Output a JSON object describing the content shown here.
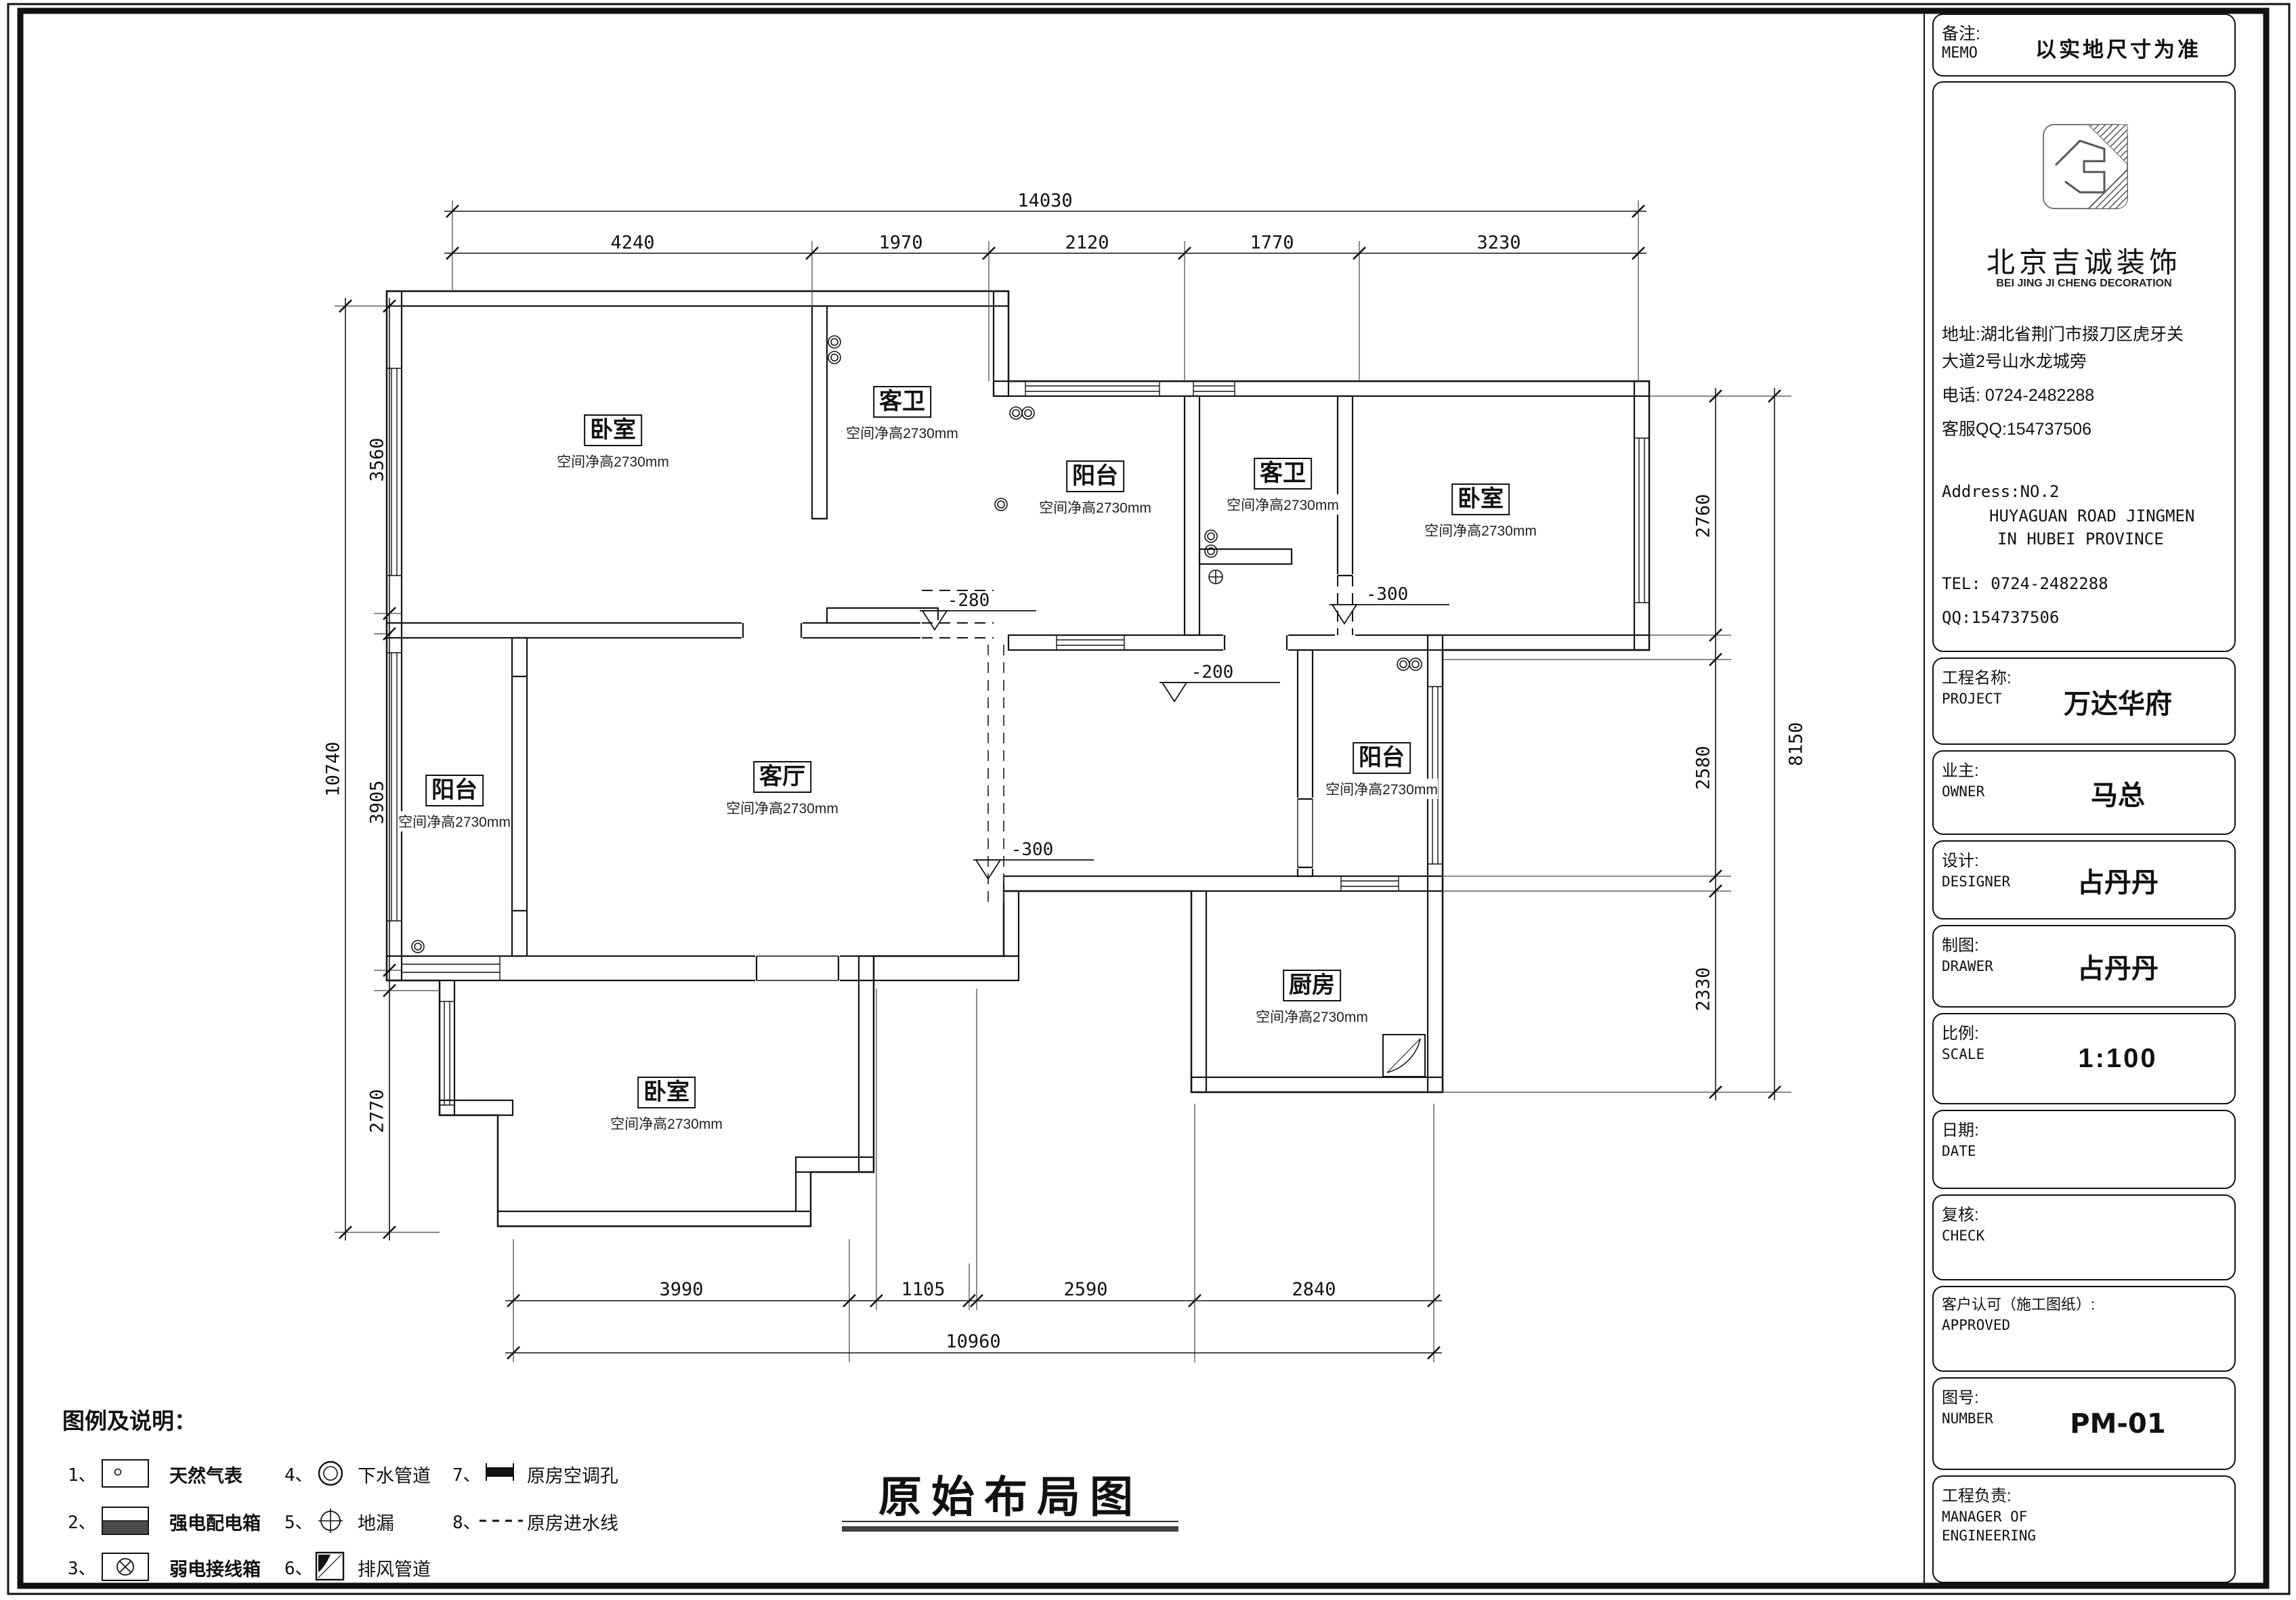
{
  "drawing_title": "原始布局图",
  "memo": {
    "label_cn": "备注:",
    "label_en": "MEMO",
    "value": "以实地尺寸为准"
  },
  "company": {
    "name_cn": "北京吉诚装饰",
    "name_en": "BEI JING JI CHENG DECORATION",
    "addr1": "地址:湖北省荆门市掇刀区虎牙关",
    "addr2": "大道2号山水龙城旁",
    "phone": "电话: 0724-2482288",
    "qq": "客服QQ:154737506",
    "addr_en1": "Address:NO.2",
    "addr_en2": "HUYAGUAN ROAD JINGMEN",
    "addr_en3": "IN HUBEI PROVINCE",
    "tel_en": "TEL: 0724-2482288",
    "qq_en": "QQ:154737506"
  },
  "titleblock": {
    "rows": [
      {
        "label_cn": "工程名称:",
        "label_en": "PROJECT",
        "value": "万达华府"
      },
      {
        "label_cn": "业主:",
        "label_en": "OWNER",
        "value": "马总"
      },
      {
        "label_cn": "设计:",
        "label_en": "DESIGNER",
        "value": "占丹丹"
      },
      {
        "label_cn": "制图:",
        "label_en": "DRAWER",
        "value": "占丹丹"
      },
      {
        "label_cn": "比例:",
        "label_en": "SCALE",
        "value": "1:100"
      },
      {
        "label_cn": "日期:",
        "label_en": "DATE",
        "value": ""
      },
      {
        "label_cn": "复核:",
        "label_en": "CHECK",
        "value": ""
      },
      {
        "label_cn": "客户认可（施工图纸）:",
        "label_en": "APPROVED",
        "value": ""
      },
      {
        "label_cn": "图号:",
        "label_en": "NUMBER",
        "value": "PM-01"
      },
      {
        "label_cn": "工程负责:",
        "label_en": "MANAGER OF",
        "label_en2": "ENGINEERING",
        "value": ""
      }
    ]
  },
  "plan": {
    "rooms": [
      {
        "name": "卧室",
        "note": "空间净高2730mm"
      },
      {
        "name": "客卫",
        "note": "空间净高2730mm"
      },
      {
        "name": "阳台",
        "note": "空间净高2730mm"
      },
      {
        "name": "客卫",
        "note": "空间净高2730mm"
      },
      {
        "name": "卧室",
        "note": "空间净高2730mm"
      },
      {
        "name": "客厅",
        "note": "空间净高2730mm"
      },
      {
        "name": "阳台",
        "note": "空间净高2730mm"
      },
      {
        "name": "阳台",
        "note": "空间净高2730mm"
      },
      {
        "name": "厨房",
        "note": "空间净高2730mm"
      },
      {
        "name": "卧室",
        "note": "空间净高2730mm"
      }
    ],
    "levels": [
      "-280",
      "-200",
      "-300",
      "-300"
    ],
    "dims": {
      "top_total": "14030",
      "top_segments": [
        "4240",
        "1970",
        "2120",
        "1770",
        "3230"
      ],
      "left_total": "10740",
      "left_segments": [
        "3560",
        "3905",
        "2770"
      ],
      "right_total": "8150",
      "right_segments": [
        "2760",
        "2580",
        "2330"
      ],
      "bottom_total": "10960",
      "bottom_segments": [
        "3990",
        "1105",
        "2590",
        "2840"
      ]
    }
  },
  "legend": {
    "title": "图例及说明：",
    "items": [
      {
        "num": "1、",
        "label": "天然气表"
      },
      {
        "num": "2、",
        "label": "强电配电箱"
      },
      {
        "num": "3、",
        "label": "弱电接线箱"
      },
      {
        "num": "4、",
        "label": "下水管道"
      },
      {
        "num": "5、",
        "label": "地漏"
      },
      {
        "num": "6、",
        "label": "排风管道"
      },
      {
        "num": "7、",
        "label": "原房空调孔"
      },
      {
        "num": "8、",
        "label": "原房进水线"
      }
    ]
  }
}
